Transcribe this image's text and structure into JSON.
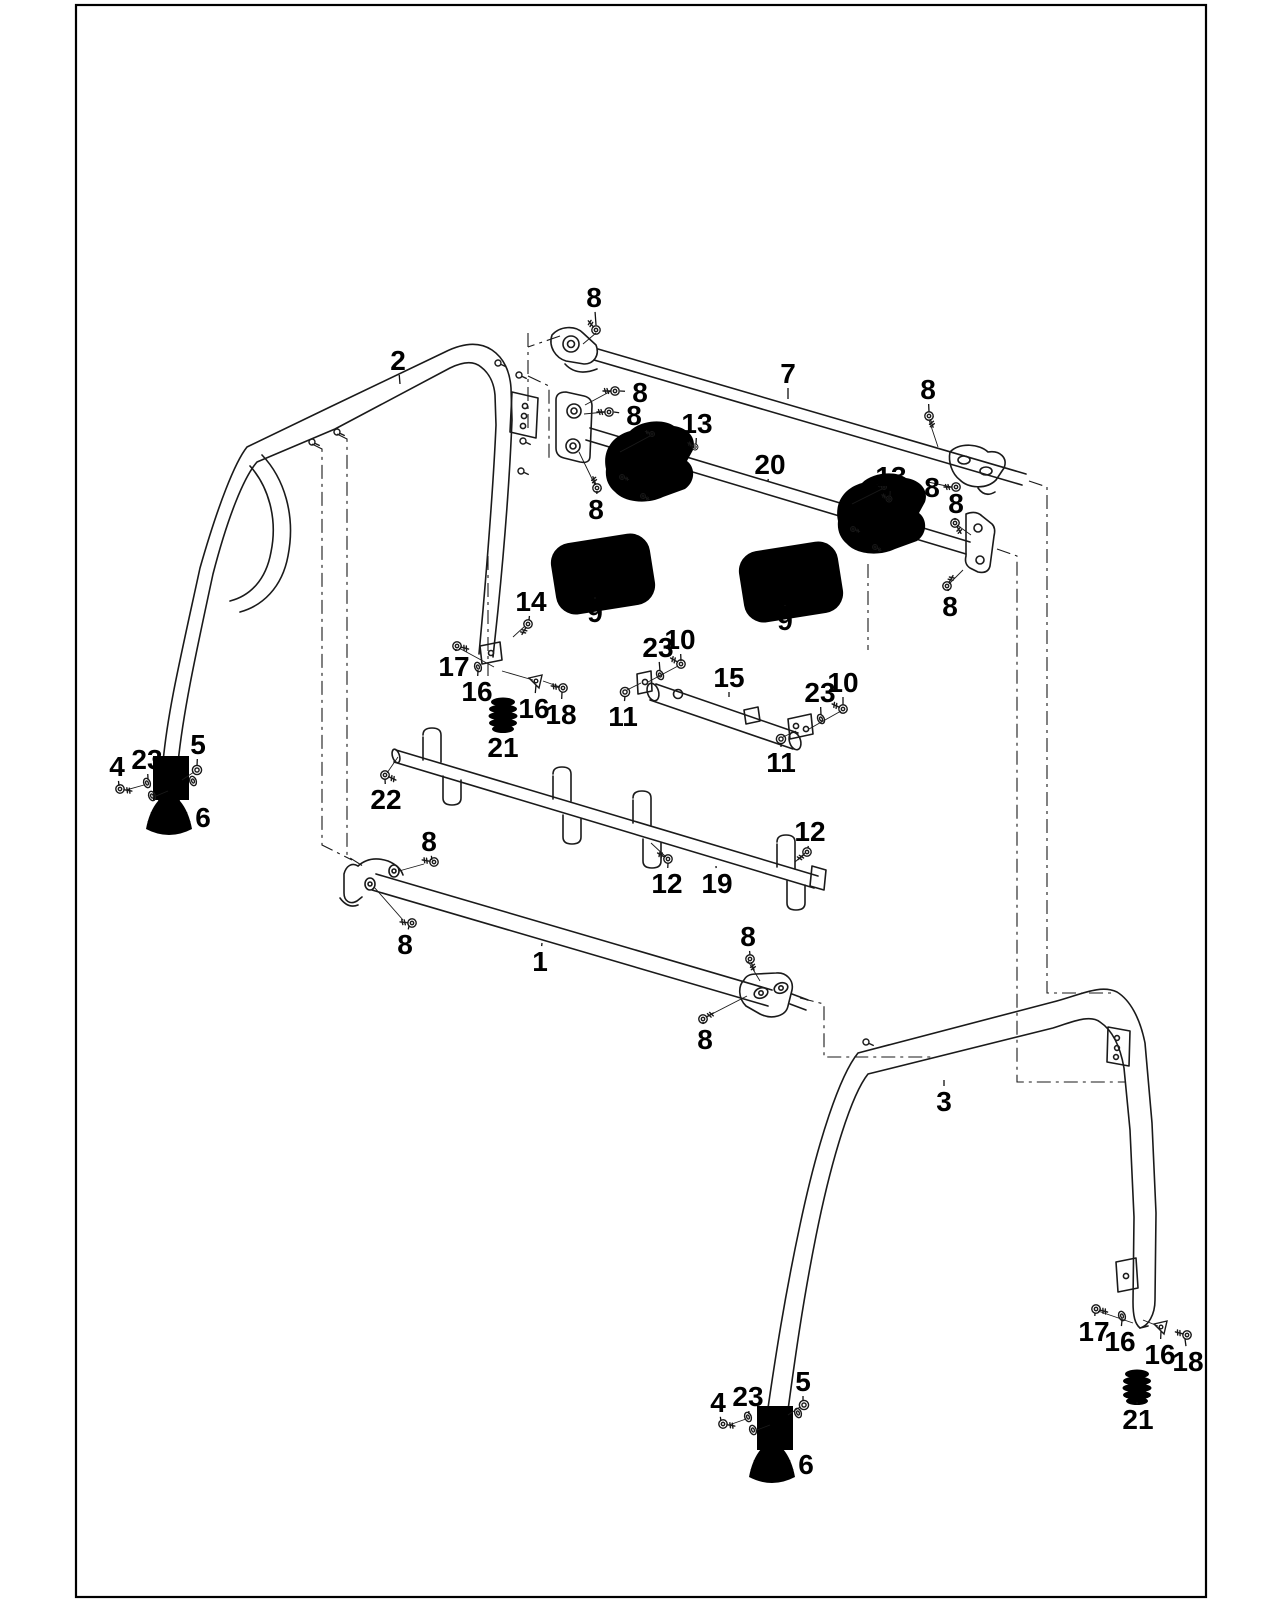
{
  "figure": {
    "kind": "exploded-parts-diagram",
    "subject": "Roll bar (ROPS) frame assembly",
    "background_color": "#ffffff",
    "line_color": "#1a1a1a",
    "label_color": "#000000"
  },
  "callouts": [
    {
      "part": "8",
      "x": 594,
      "y": 297,
      "tx": 596,
      "ty": 325
    },
    {
      "part": "2",
      "x": 398,
      "y": 360,
      "tx": 400,
      "ty": 384
    },
    {
      "part": "8",
      "x": 640,
      "y": 392,
      "tx": 620,
      "ty": 391
    },
    {
      "part": "8",
      "x": 634,
      "y": 415,
      "tx": 614,
      "ty": 412
    },
    {
      "part": "13",
      "x": 697,
      "y": 423,
      "tx": 696,
      "ty": 444
    },
    {
      "part": "7",
      "x": 788,
      "y": 373,
      "tx": 788,
      "ty": 399
    },
    {
      "part": "8",
      "x": 928,
      "y": 389,
      "tx": 929,
      "ty": 412
    },
    {
      "part": "20",
      "x": 770,
      "y": 464,
      "tx": 768,
      "ty": 481
    },
    {
      "part": "13",
      "x": 891,
      "y": 476,
      "tx": 890,
      "ty": 496
    },
    {
      "part": "8",
      "x": 932,
      "y": 487,
      "tx": 950,
      "ty": 487
    },
    {
      "part": "8",
      "x": 956,
      "y": 503,
      "tx": 955,
      "ty": 520
    },
    {
      "part": "8",
      "x": 950,
      "y": 606,
      "tx": 948,
      "ty": 589
    },
    {
      "part": "8",
      "x": 596,
      "y": 509,
      "tx": 597,
      "ty": 491
    },
    {
      "part": "9",
      "x": 595,
      "y": 612,
      "tx": 595,
      "ty": 599
    },
    {
      "part": "9",
      "x": 785,
      "y": 620,
      "tx": 785,
      "ty": 606
    },
    {
      "part": "14",
      "x": 531,
      "y": 601,
      "tx": 529,
      "ty": 620
    },
    {
      "part": "17",
      "x": 454,
      "y": 666,
      "tx": 456,
      "ty": 649
    },
    {
      "part": "16",
      "x": 477,
      "y": 691,
      "tx": 478,
      "ty": 670
    },
    {
      "part": "16",
      "x": 534,
      "y": 708,
      "tx": 536,
      "ty": 685
    },
    {
      "part": "18",
      "x": 561,
      "y": 714,
      "tx": 562,
      "ty": 692
    },
    {
      "part": "21",
      "x": 503,
      "y": 747,
      "tx": 503,
      "ty": 732
    },
    {
      "part": "23",
      "x": 658,
      "y": 647,
      "tx": 660,
      "ty": 671
    },
    {
      "part": "10",
      "x": 680,
      "y": 639,
      "tx": 681,
      "ty": 661
    },
    {
      "part": "15",
      "x": 729,
      "y": 677,
      "tx": 729,
      "ty": 697
    },
    {
      "part": "11",
      "x": 623,
      "y": 716,
      "tx": 625,
      "ty": 696
    },
    {
      "part": "23",
      "x": 820,
      "y": 692,
      "tx": 821,
      "ty": 715
    },
    {
      "part": "10",
      "x": 843,
      "y": 682,
      "tx": 843,
      "ty": 705
    },
    {
      "part": "11",
      "x": 781,
      "y": 762,
      "tx": 781,
      "ty": 743
    },
    {
      "part": "22",
      "x": 386,
      "y": 799,
      "tx": 385,
      "ty": 779
    },
    {
      "part": "4",
      "x": 117,
      "y": 766,
      "tx": 119,
      "ty": 786
    },
    {
      "part": "23",
      "x": 147,
      "y": 759,
      "tx": 148,
      "ty": 779
    },
    {
      "part": "5",
      "x": 198,
      "y": 744,
      "tx": 197,
      "ty": 766
    },
    {
      "part": "6",
      "x": 203,
      "y": 817,
      "tx": 188,
      "ty": 817
    },
    {
      "part": "8",
      "x": 429,
      "y": 841,
      "tx": 432,
      "ty": 860
    },
    {
      "part": "8",
      "x": 405,
      "y": 944,
      "tx": 409,
      "ty": 926
    },
    {
      "part": "12",
      "x": 667,
      "y": 883,
      "tx": 668,
      "ty": 863
    },
    {
      "part": "19",
      "x": 717,
      "y": 883,
      "tx": 716,
      "ty": 866
    },
    {
      "part": "12",
      "x": 810,
      "y": 831,
      "tx": 808,
      "ty": 848
    },
    {
      "part": "1",
      "x": 540,
      "y": 961,
      "tx": 542,
      "ty": 943
    },
    {
      "part": "8",
      "x": 748,
      "y": 936,
      "tx": 750,
      "ty": 955
    },
    {
      "part": "8",
      "x": 705,
      "y": 1039,
      "tx": 703,
      "ty": 1022
    },
    {
      "part": "3",
      "x": 944,
      "y": 1101,
      "tx": 944,
      "ty": 1080
    },
    {
      "part": "17",
      "x": 1094,
      "y": 1331,
      "tx": 1095,
      "ty": 1313
    },
    {
      "part": "16",
      "x": 1120,
      "y": 1341,
      "tx": 1122,
      "ty": 1320
    },
    {
      "part": "16",
      "x": 1160,
      "y": 1354,
      "tx": 1161,
      "ty": 1331
    },
    {
      "part": "18",
      "x": 1188,
      "y": 1361,
      "tx": 1185,
      "ty": 1339
    },
    {
      "part": "21",
      "x": 1138,
      "y": 1419,
      "tx": 1137,
      "ty": 1402
    },
    {
      "part": "4",
      "x": 718,
      "y": 1402,
      "tx": 721,
      "ty": 1421
    },
    {
      "part": "23",
      "x": 748,
      "y": 1396,
      "tx": 749,
      "ty": 1414
    },
    {
      "part": "5",
      "x": 803,
      "y": 1381,
      "tx": 803,
      "ty": 1401
    },
    {
      "part": "6",
      "x": 806,
      "y": 1464,
      "tx": 791,
      "ty": 1464
    }
  ],
  "hardware": [
    {
      "t": "screw",
      "x": 596,
      "y": 330,
      "a": 230
    },
    {
      "t": "screw",
      "x": 615,
      "y": 391,
      "a": 180
    },
    {
      "t": "screw",
      "x": 609,
      "y": 412,
      "a": 180
    },
    {
      "t": "screw",
      "x": 597,
      "y": 488,
      "a": 250
    },
    {
      "t": "screw",
      "x": 929,
      "y": 416,
      "a": 70
    },
    {
      "t": "screw",
      "x": 956,
      "y": 487,
      "a": 180
    },
    {
      "t": "screw",
      "x": 955,
      "y": 523,
      "a": 60
    },
    {
      "t": "screw",
      "x": 947,
      "y": 586,
      "a": 300
    },
    {
      "t": "screw",
      "x": 434,
      "y": 862,
      "a": 190
    },
    {
      "t": "screw",
      "x": 412,
      "y": 923,
      "a": 185
    },
    {
      "t": "screw",
      "x": 750,
      "y": 959,
      "a": 70
    },
    {
      "t": "screw",
      "x": 703,
      "y": 1019,
      "a": 330
    },
    {
      "t": "screw",
      "x": 668,
      "y": 859,
      "a": 210
    },
    {
      "t": "screw",
      "x": 807,
      "y": 852,
      "a": 140
    },
    {
      "t": "screw",
      "x": 385,
      "y": 775,
      "a": 25
    },
    {
      "t": "screw",
      "x": 457,
      "y": 646,
      "a": 15
    },
    {
      "t": "screw",
      "x": 563,
      "y": 688,
      "a": 190
    },
    {
      "t": "screw",
      "x": 1096,
      "y": 1309,
      "a": 15
    },
    {
      "t": "screw",
      "x": 1187,
      "y": 1335,
      "a": 195
    },
    {
      "t": "screw",
      "x": 528,
      "y": 624,
      "a": 120
    },
    {
      "t": "screw",
      "x": 681,
      "y": 664,
      "a": 210
    },
    {
      "t": "screw",
      "x": 843,
      "y": 709,
      "a": 205
    },
    {
      "t": "screw",
      "x": 695,
      "y": 447,
      "a": 210,
      "s": 0.7
    },
    {
      "t": "screw",
      "x": 889,
      "y": 499,
      "a": 210,
      "s": 0.7
    },
    {
      "t": "screw",
      "x": 652,
      "y": 434,
      "a": 200,
      "s": 0.6
    },
    {
      "t": "screw",
      "x": 622,
      "y": 477,
      "a": 20,
      "s": 0.6
    },
    {
      "t": "screw",
      "x": 643,
      "y": 496,
      "a": 30,
      "s": 0.6
    },
    {
      "t": "screw",
      "x": 884,
      "y": 487,
      "a": 200,
      "s": 0.6
    },
    {
      "t": "screw",
      "x": 853,
      "y": 529,
      "a": 20,
      "s": 0.6
    },
    {
      "t": "screw",
      "x": 875,
      "y": 547,
      "a": 30,
      "s": 0.6
    },
    {
      "t": "screw",
      "x": 120,
      "y": 789,
      "a": 10
    },
    {
      "t": "screw",
      "x": 723,
      "y": 1424,
      "a": 10
    },
    {
      "t": "washer",
      "x": 478,
      "y": 667,
      "a": -20
    },
    {
      "t": "washer",
      "x": 1122,
      "y": 1316,
      "a": -20
    },
    {
      "t": "washer",
      "x": 660,
      "y": 675,
      "a": -25
    },
    {
      "t": "washer",
      "x": 821,
      "y": 719,
      "a": -25
    },
    {
      "t": "washer",
      "x": 147,
      "y": 783,
      "a": -20
    },
    {
      "t": "washer",
      "x": 152,
      "y": 796,
      "a": -20
    },
    {
      "t": "washer",
      "x": 193,
      "y": 781,
      "a": -20
    },
    {
      "t": "washer",
      "x": 748,
      "y": 1417,
      "a": -20
    },
    {
      "t": "washer",
      "x": 753,
      "y": 1430,
      "a": -20
    },
    {
      "t": "washer",
      "x": 798,
      "y": 1413,
      "a": -20
    },
    {
      "t": "nut",
      "x": 197,
      "y": 770
    },
    {
      "t": "nut",
      "x": 804,
      "y": 1405
    },
    {
      "t": "nut",
      "x": 625,
      "y": 692
    },
    {
      "t": "nut",
      "x": 781,
      "y": 739
    },
    {
      "t": "wclip",
      "x": 536,
      "y": 681,
      "a": 0
    },
    {
      "t": "wclip",
      "x": 1161,
      "y": 1327,
      "a": 0
    },
    {
      "t": "hole",
      "x": 312,
      "y": 442,
      "a": 25
    },
    {
      "t": "hole",
      "x": 337,
      "y": 432,
      "a": 25
    },
    {
      "t": "hole",
      "x": 498,
      "y": 363,
      "a": 25
    },
    {
      "t": "hole",
      "x": 519,
      "y": 375,
      "a": 25
    },
    {
      "t": "hole",
      "x": 523,
      "y": 441,
      "a": 25
    },
    {
      "t": "hole",
      "x": 521,
      "y": 471,
      "a": 25
    },
    {
      "t": "hole",
      "x": 866,
      "y": 1042,
      "a": 25
    }
  ]
}
